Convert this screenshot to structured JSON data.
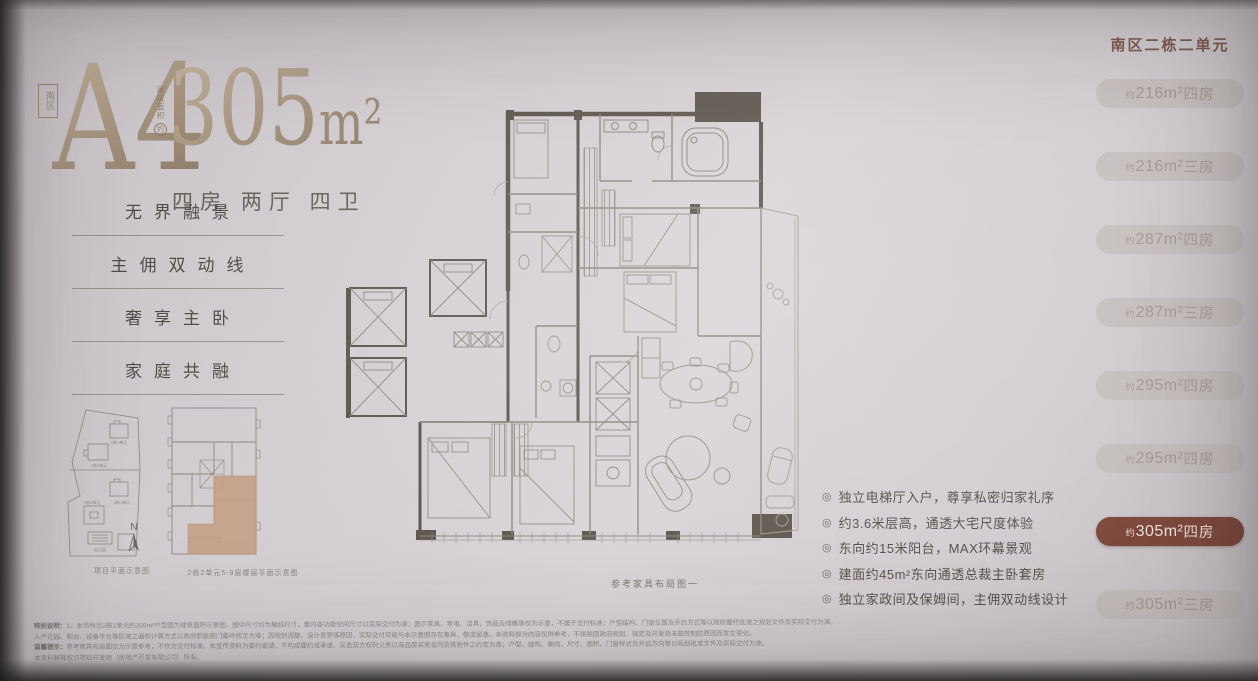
{
  "header": {
    "zone": "南区",
    "unit": "A4",
    "area_label": "建筑面积",
    "approx": "约",
    "area_value": "305",
    "area_unit": "m²",
    "layout": "四房 两厅 四卫"
  },
  "selling_points": [
    "无界融景",
    "主佣双动线",
    "奢享主卧",
    "家庭共融"
  ],
  "thumbnails": {
    "site_caption": "项目平面示意图",
    "compass": "N",
    "floor_caption": "2栋2单元5-9层楼层平面示意图",
    "site_labels": [
      "1栋1单元",
      "1栋2单元",
      "2栋1单元",
      "2栋2单元",
      "幼儿园"
    ]
  },
  "floorplan": {
    "caption": "参考家具布局图一"
  },
  "sidebar": {
    "title": "南区二栋二单元",
    "items": [
      {
        "approx": "约",
        "area": "216m²",
        "rooms": "四房",
        "active": false
      },
      {
        "approx": "约",
        "area": "216m²",
        "rooms": "三房",
        "active": false
      },
      {
        "approx": "约",
        "area": "287m²",
        "rooms": "四房",
        "active": false
      },
      {
        "approx": "约",
        "area": "287m²",
        "rooms": "三房",
        "active": false
      },
      {
        "approx": "约",
        "area": "295m²",
        "rooms": "四房",
        "active": false
      },
      {
        "approx": "约",
        "area": "295m²",
        "rooms": "四房",
        "active": false
      },
      {
        "approx": "约",
        "area": "305m²",
        "rooms": "四房",
        "active": true
      },
      {
        "approx": "约",
        "area": "305m²",
        "rooms": "三房",
        "active": false
      }
    ]
  },
  "features": {
    "icon": "◎",
    "items": [
      "独立电梯厅入户，尊享私密归家礼序",
      "约3.6米层高，通透大宅尺度体验",
      "东向约15米阳台，MAX环幕景观",
      "建面约45m²东向通透总裁主卧套房",
      "独立家政间及保姆间，主佣双动线设计"
    ]
  },
  "disclaimer": {
    "lines": [
      {
        "lead": "特别说明：",
        "text": "1、本页所示2栋2单元约305m²户型图为建筑面积示意图，图中尺寸均为轴线尺寸，套内各功能空间尺寸以实际交付为准；图示家具、家电、洁具、饰品及绿植等仅为示意，不属于交付标准；户型结构、门窗位置及开启方式等以政府最终批准之规划文件及实际交付为准。"
      },
      {
        "lead": "",
        "text": "入户花园、阳台、设备平台等区域之面积计算方式以政府职能部门最终核定为准；因规划调整、设计变更等原因，实际交付可能与本示意图存在差异，敬请留意。本资料部分内容仅供参考，不排除因政府规划、规定及开发商未能控制的原因而发生变化。"
      },
      {
        "lead": "温馨提示：",
        "text": "参考家具布局图仅为示意参考，不作为交付标准。本宣传资料为要约邀请，不构成要约或承诺，买卖双方权利义务以商品房买卖合同及其附件之约定为准；户型、结构、朝向、尺寸、面积、门窗样式及开启方向等以规划批准文件及实际交付为准。"
      },
      {
        "lead": "",
        "text": "本资料解释权归项目开发商（房地产开发有限公司）所有。"
      }
    ]
  },
  "colors": {
    "accent": "#7b4639",
    "bronze": "#9a8772",
    "tan": "#c4a186",
    "wall": "#5d564d"
  }
}
